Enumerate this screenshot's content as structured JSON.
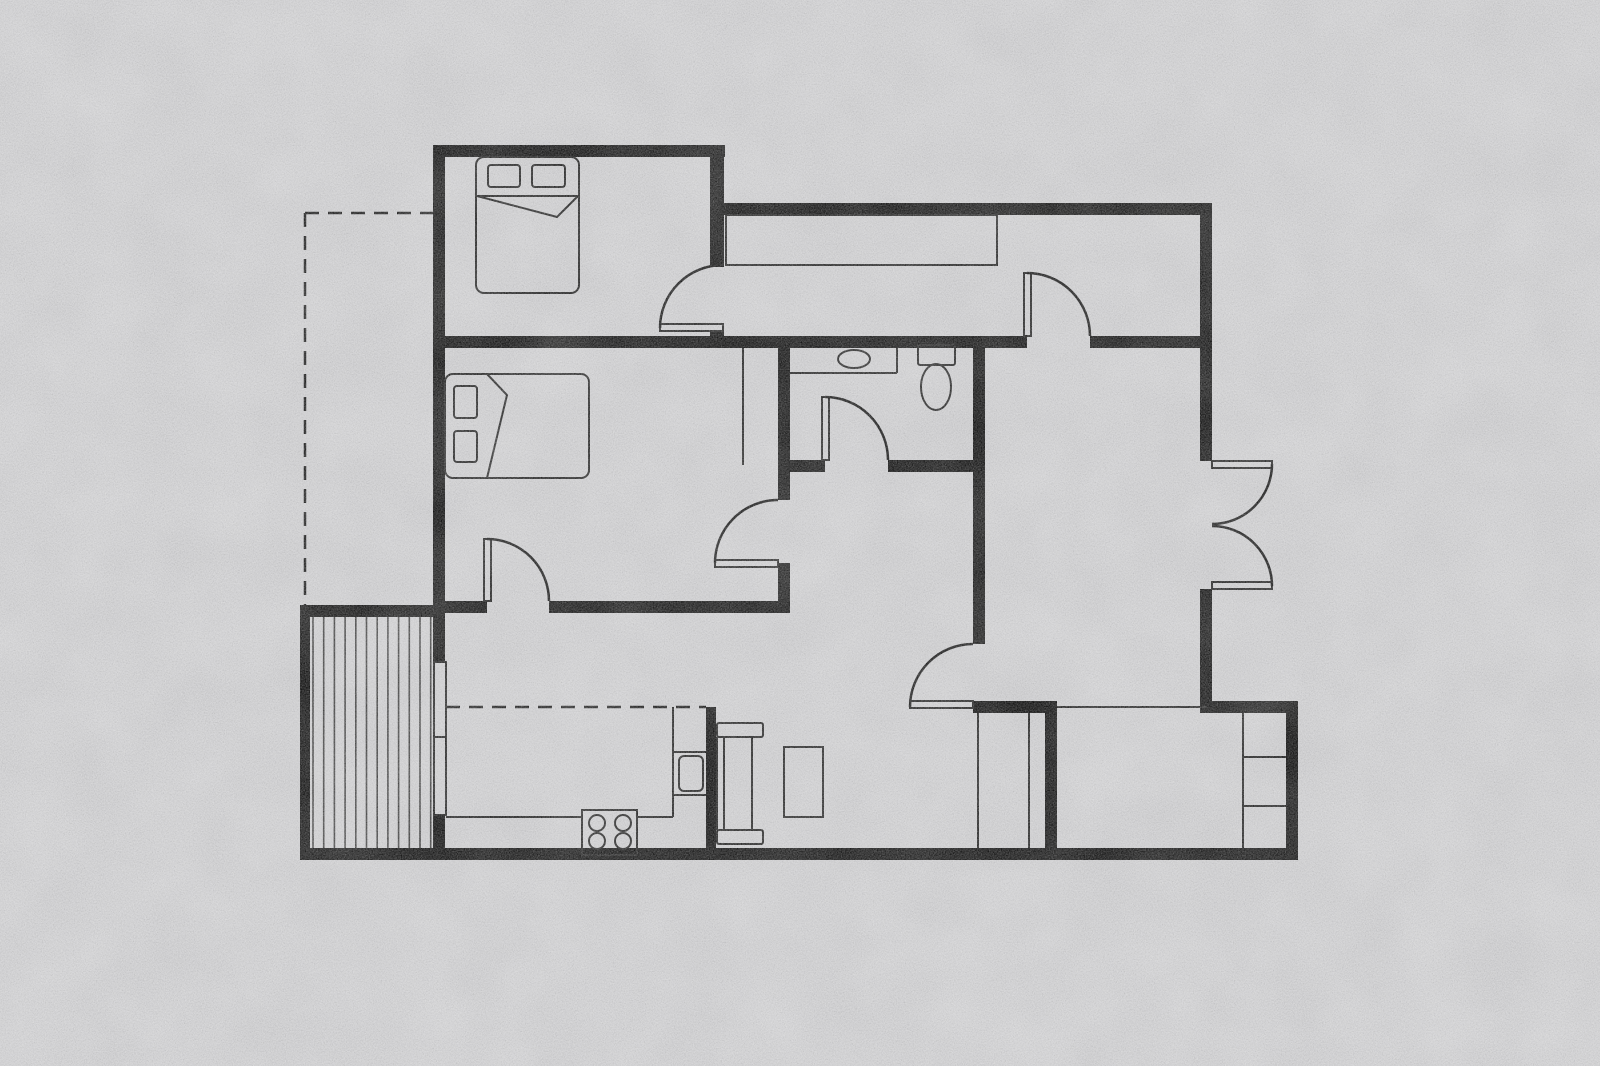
{
  "title": "apartment-floor-plan",
  "canvas": {
    "w": 1600,
    "h": 1066,
    "bg": "#c9c9cb",
    "wall": "#0d0d0d",
    "line": "#1f1f1f"
  },
  "floorplan": {
    "rooms": [
      {
        "name": "bedroom-1",
        "x": 445,
        "y": 157,
        "w": 265,
        "h": 179
      },
      {
        "name": "entry-hall",
        "x": 724,
        "y": 215,
        "w": 476,
        "h": 121
      },
      {
        "name": "bedroom-2",
        "x": 445,
        "y": 348,
        "w": 333,
        "h": 253
      },
      {
        "name": "bathroom",
        "x": 790,
        "y": 348,
        "w": 183,
        "h": 112
      },
      {
        "name": "living-room",
        "x": 985,
        "y": 348,
        "w": 215,
        "h": 353
      },
      {
        "name": "dining-area",
        "x": 715,
        "y": 472,
        "w": 258,
        "h": 376
      },
      {
        "name": "kitchen",
        "x": 445,
        "y": 613,
        "w": 261,
        "h": 235
      },
      {
        "name": "deck",
        "x": 310,
        "y": 617,
        "w": 123,
        "h": 231
      },
      {
        "name": "storage-room",
        "x": 1057,
        "y": 713,
        "w": 229,
        "h": 135
      },
      {
        "name": "utility-closet",
        "x": 985,
        "y": 713,
        "w": 60,
        "h": 135
      }
    ],
    "walls": [
      {
        "name": "wall-bedroom1-top",
        "r": [
          433,
          145,
          292,
          12
        ]
      },
      {
        "name": "wall-bedroom1-right-a",
        "r": [
          710,
          145,
          14,
          122
        ]
      },
      {
        "name": "wall-bedroom1-right-b",
        "r": [
          710,
          330,
          14,
          18
        ]
      },
      {
        "name": "wall-hall-top",
        "r": [
          710,
          203,
          502,
          12
        ]
      },
      {
        "name": "wall-east-upper",
        "r": [
          1200,
          203,
          12,
          258
        ]
      },
      {
        "name": "wall-east-lower",
        "r": [
          1200,
          589,
          12,
          124
        ]
      },
      {
        "name": "wall-mid-band-west",
        "r": [
          433,
          336,
          594,
          12
        ]
      },
      {
        "name": "wall-mid-band-east",
        "r": [
          1090,
          336,
          122,
          12
        ]
      },
      {
        "name": "wall-west-upper",
        "r": [
          433,
          145,
          12,
          517
        ]
      },
      {
        "name": "wall-west-lower",
        "r": [
          433,
          815,
          12,
          45
        ]
      },
      {
        "name": "wall-bathroom-left",
        "r": [
          778,
          348,
          12,
          117
        ]
      },
      {
        "name": "wall-bedroom2-east-a",
        "r": [
          778,
          465,
          12,
          35
        ]
      },
      {
        "name": "wall-bedroom2-east-b",
        "r": [
          778,
          563,
          12,
          50
        ]
      },
      {
        "name": "wall-bathroom-bottom-a",
        "r": [
          790,
          460,
          35,
          12
        ]
      },
      {
        "name": "wall-bathroom-bottom-b",
        "r": [
          888,
          460,
          85,
          12
        ]
      },
      {
        "name": "wall-bathroom-right",
        "r": [
          973,
          348,
          12,
          296
        ]
      },
      {
        "name": "wall-bedroom2-south-a",
        "r": [
          445,
          601,
          42,
          12
        ]
      },
      {
        "name": "wall-bedroom2-south-b",
        "r": [
          549,
          601,
          229,
          12
        ]
      },
      {
        "name": "wall-deck-left",
        "r": [
          300,
          605,
          10,
          255
        ]
      },
      {
        "name": "wall-deck-top",
        "r": [
          300,
          605,
          145,
          12
        ]
      },
      {
        "name": "wall-kitchen-divider",
        "r": [
          706,
          707,
          10,
          153
        ]
      },
      {
        "name": "wall-bottom",
        "r": [
          300,
          848,
          998,
          12
        ]
      },
      {
        "name": "wall-living-south",
        "r": [
          973,
          701,
          84,
          12
        ]
      },
      {
        "name": "wall-storage-west",
        "r": [
          1045,
          713,
          12,
          135
        ]
      },
      {
        "name": "wall-storage-top",
        "r": [
          1207,
          701,
          91,
          12
        ]
      },
      {
        "name": "wall-storage-east",
        "r": [
          1286,
          701,
          12,
          159
        ]
      }
    ],
    "windows": [
      {
        "name": "kitchen-window",
        "r": [
          434,
          662,
          12,
          153
        ]
      }
    ],
    "lines": [
      {
        "name": "window-divider",
        "p": [
          434,
          737,
          446,
          737
        ]
      },
      {
        "name": "closet-front-line",
        "p": [
          743,
          348,
          743,
          465
        ]
      },
      {
        "name": "storage-opening-edge",
        "p": [
          1057,
          707,
          1207,
          707
        ]
      },
      {
        "name": "utility-closet-left",
        "p": [
          978,
          713,
          978,
          848
        ]
      },
      {
        "name": "utility-closet-divider",
        "p": [
          1029,
          713,
          1029,
          848
        ]
      },
      {
        "name": "shelf-unit-front",
        "p": [
          1243,
          713,
          1243,
          848
        ]
      },
      {
        "name": "shelf-divider-1",
        "p": [
          1243,
          757,
          1286,
          757
        ]
      },
      {
        "name": "shelf-divider-2",
        "p": [
          1243,
          806,
          1286,
          806
        ]
      },
      {
        "name": "counter-edge-bottom-1",
        "p": [
          446,
          817,
          582,
          817
        ]
      },
      {
        "name": "counter-edge-bottom-2",
        "p": [
          637,
          817,
          673,
          817
        ]
      },
      {
        "name": "counter-edge-right",
        "p": [
          673,
          707,
          673,
          817
        ]
      },
      {
        "name": "counter-divider-1",
        "p": [
          673,
          752,
          706,
          752
        ]
      },
      {
        "name": "counter-divider-2",
        "p": [
          673,
          795,
          706,
          795
        ]
      },
      {
        "name": "vanity-front",
        "p": [
          790,
          373,
          897,
          373
        ]
      },
      {
        "name": "vanity-side",
        "p": [
          897,
          348,
          897,
          373
        ]
      },
      {
        "name": "sofa-left-edge",
        "p": [
          717,
          737,
          717,
          830
        ]
      },
      {
        "name": "sofa-back-line",
        "p": [
          724,
          737,
          724,
          830
        ]
      },
      {
        "name": "sofa-front-line",
        "p": [
          752,
          737,
          752,
          830
        ]
      },
      {
        "name": "bed1-blanket-line",
        "p": [
          477,
          196,
          578,
          196
        ]
      }
    ],
    "dashed_lines": [
      {
        "name": "setback-dashed-top",
        "p": [
          305,
          213,
          433,
          213
        ]
      },
      {
        "name": "setback-dashed-left",
        "p": [
          305,
          213,
          305,
          605
        ]
      },
      {
        "name": "kitchen-upper-cabinet-line",
        "p": [
          446,
          707,
          706,
          707
        ]
      }
    ],
    "rects": [
      {
        "name": "hall-wardrobe",
        "r": [
          726,
          215,
          271,
          50
        ],
        "rx": 0
      },
      {
        "name": "bed-1",
        "r": [
          476,
          157,
          103,
          136
        ],
        "rx": 8
      },
      {
        "name": "bed1-pillow-1",
        "r": [
          488,
          165,
          32,
          22
        ],
        "rx": 3
      },
      {
        "name": "bed1-pillow-2",
        "r": [
          532,
          165,
          33,
          22
        ],
        "rx": 3
      },
      {
        "name": "bed-2",
        "r": [
          445,
          374,
          144,
          104
        ],
        "rx": 8
      },
      {
        "name": "bed2-pillow-1",
        "r": [
          454,
          386,
          23,
          32
        ],
        "rx": 3
      },
      {
        "name": "bed2-pillow-2",
        "r": [
          454,
          431,
          23,
          31
        ],
        "rx": 3
      },
      {
        "name": "sofa-arm-top",
        "r": [
          717,
          723,
          46,
          14
        ],
        "rx": 2
      },
      {
        "name": "sofa-arm-bottom",
        "r": [
          717,
          830,
          46,
          14
        ],
        "rx": 2
      },
      {
        "name": "coffee-table",
        "r": [
          784,
          747,
          39,
          70
        ],
        "rx": 0
      },
      {
        "name": "stove",
        "r": [
          582,
          810,
          55,
          45
        ],
        "rx": 0
      },
      {
        "name": "oven",
        "r": [
          679,
          756,
          24,
          35
        ],
        "rx": 5
      },
      {
        "name": "toilet-tank",
        "r": [
          918,
          345,
          37,
          20
        ],
        "rx": 2
      }
    ],
    "polylines": [
      {
        "name": "bed1-blanket-fold",
        "pts": [
          [
            477,
            196
          ],
          [
            557,
            217
          ],
          [
            578,
            196
          ]
        ]
      },
      {
        "name": "bed2-blanket-fold",
        "pts": [
          [
            487,
            374
          ],
          [
            507,
            395
          ],
          [
            487,
            478
          ]
        ]
      }
    ],
    "ellipses": [
      {
        "name": "bathroom-sink",
        "c": [
          854,
          359,
          16,
          9
        ]
      },
      {
        "name": "toilet-bowl",
        "c": [
          936,
          387,
          15,
          23
        ]
      }
    ],
    "circles": [
      {
        "name": "burner-1",
        "c": [
          597,
          823,
          8
        ]
      },
      {
        "name": "burner-2",
        "c": [
          623,
          823,
          8
        ]
      },
      {
        "name": "burner-3",
        "c": [
          597,
          841,
          8
        ]
      },
      {
        "name": "burner-4",
        "c": [
          623,
          841,
          8
        ]
      }
    ],
    "doors": [
      {
        "name": "bedroom1-door",
        "leaf": [
          660,
          324,
          63,
          7
        ],
        "arc": [
          660,
          328,
          63,
          1,
          723,
          265
        ]
      },
      {
        "name": "hall-door",
        "leaf": [
          1024,
          273,
          7,
          63
        ],
        "arc": [
          1027,
          273,
          63,
          1,
          1090,
          336
        ]
      },
      {
        "name": "bathroom-door",
        "leaf": [
          822,
          397,
          7,
          63
        ],
        "arc": [
          825,
          397,
          63,
          1,
          888,
          460
        ]
      },
      {
        "name": "bedroom2-east-door",
        "leaf": [
          715,
          560,
          63,
          7
        ],
        "arc": [
          715,
          563,
          63,
          1,
          778,
          500
        ]
      },
      {
        "name": "bedroom2-south-door",
        "leaf": [
          484,
          539,
          7,
          62
        ],
        "arc": [
          487,
          539,
          62,
          1,
          549,
          601
        ]
      },
      {
        "name": "dining-door",
        "leaf": [
          910,
          701,
          63,
          7
        ],
        "arc": [
          910,
          707,
          63,
          1,
          973,
          644
        ]
      },
      {
        "name": "french-door-top",
        "leaf": [
          1212,
          461,
          60,
          7
        ],
        "arc": [
          1272,
          464,
          60,
          1,
          1212,
          524
        ]
      },
      {
        "name": "french-door-bottom",
        "leaf": [
          1212,
          582,
          60,
          7
        ],
        "arc": [
          1272,
          586,
          60,
          0,
          1212,
          526
        ]
      }
    ],
    "hatch": {
      "name": "deck-boards",
      "x1": 313,
      "x2": 441,
      "y1": 617,
      "y2": 848,
      "step": 10.7
    }
  }
}
